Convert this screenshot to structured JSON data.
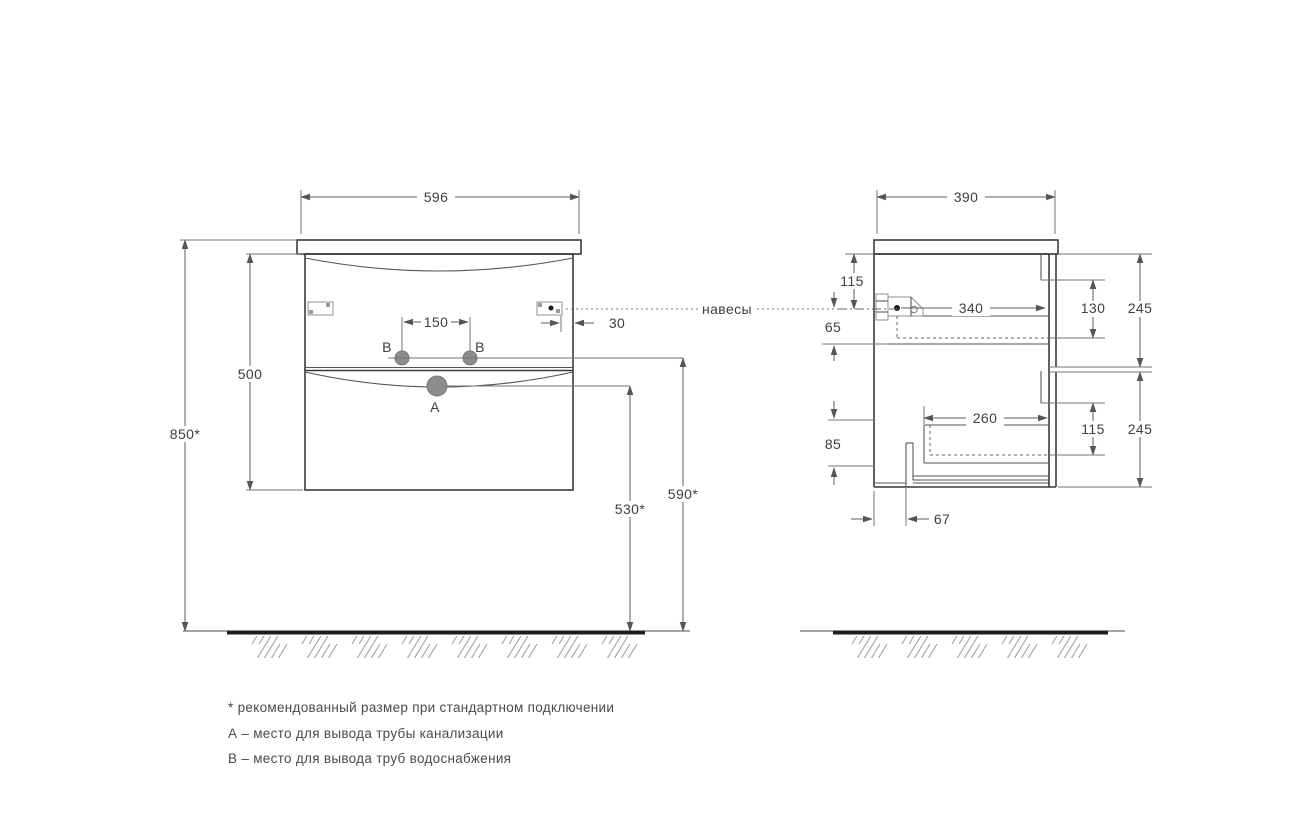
{
  "front_view": {
    "dim_width": "596",
    "dim_total_height": "850*",
    "dim_body_height": "500",
    "dim_b_spacing": "150",
    "dim_hinge_offset": "30",
    "dim_b_height": "590*",
    "dim_a_height": "530*",
    "label_hole_a": "A",
    "label_hole_b_left": "B",
    "label_hole_b_right": "B"
  },
  "side_view": {
    "dim_depth": "390",
    "dim_hinge_top": "115",
    "dim_hinge_drop": "65",
    "dim_top_drawer_depth": "340",
    "dim_top_drawer_height": "130",
    "dim_top_front_height": "245",
    "dim_bottom_drawer_depth": "260",
    "dim_bottom_drawer_height": "115",
    "dim_bottom_front_height": "245",
    "dim_bottom_recess": "85",
    "dim_back_offset": "67"
  },
  "callouts": {
    "hangers": "навесы"
  },
  "notes": {
    "asterisk": "* рекомендованный размер при стандартном подключении",
    "a": "А – место для вывода трубы канализации",
    "b": "В – место для вывода труб водоснабжения"
  },
  "colors": {
    "outline": "#3a3a3a",
    "dimension": "#5c5c5c",
    "text": "#3f3f3f",
    "hole_fill": "#8c8c8c",
    "floor": "#1d1d1d",
    "hatch": "#9a9a9a"
  }
}
